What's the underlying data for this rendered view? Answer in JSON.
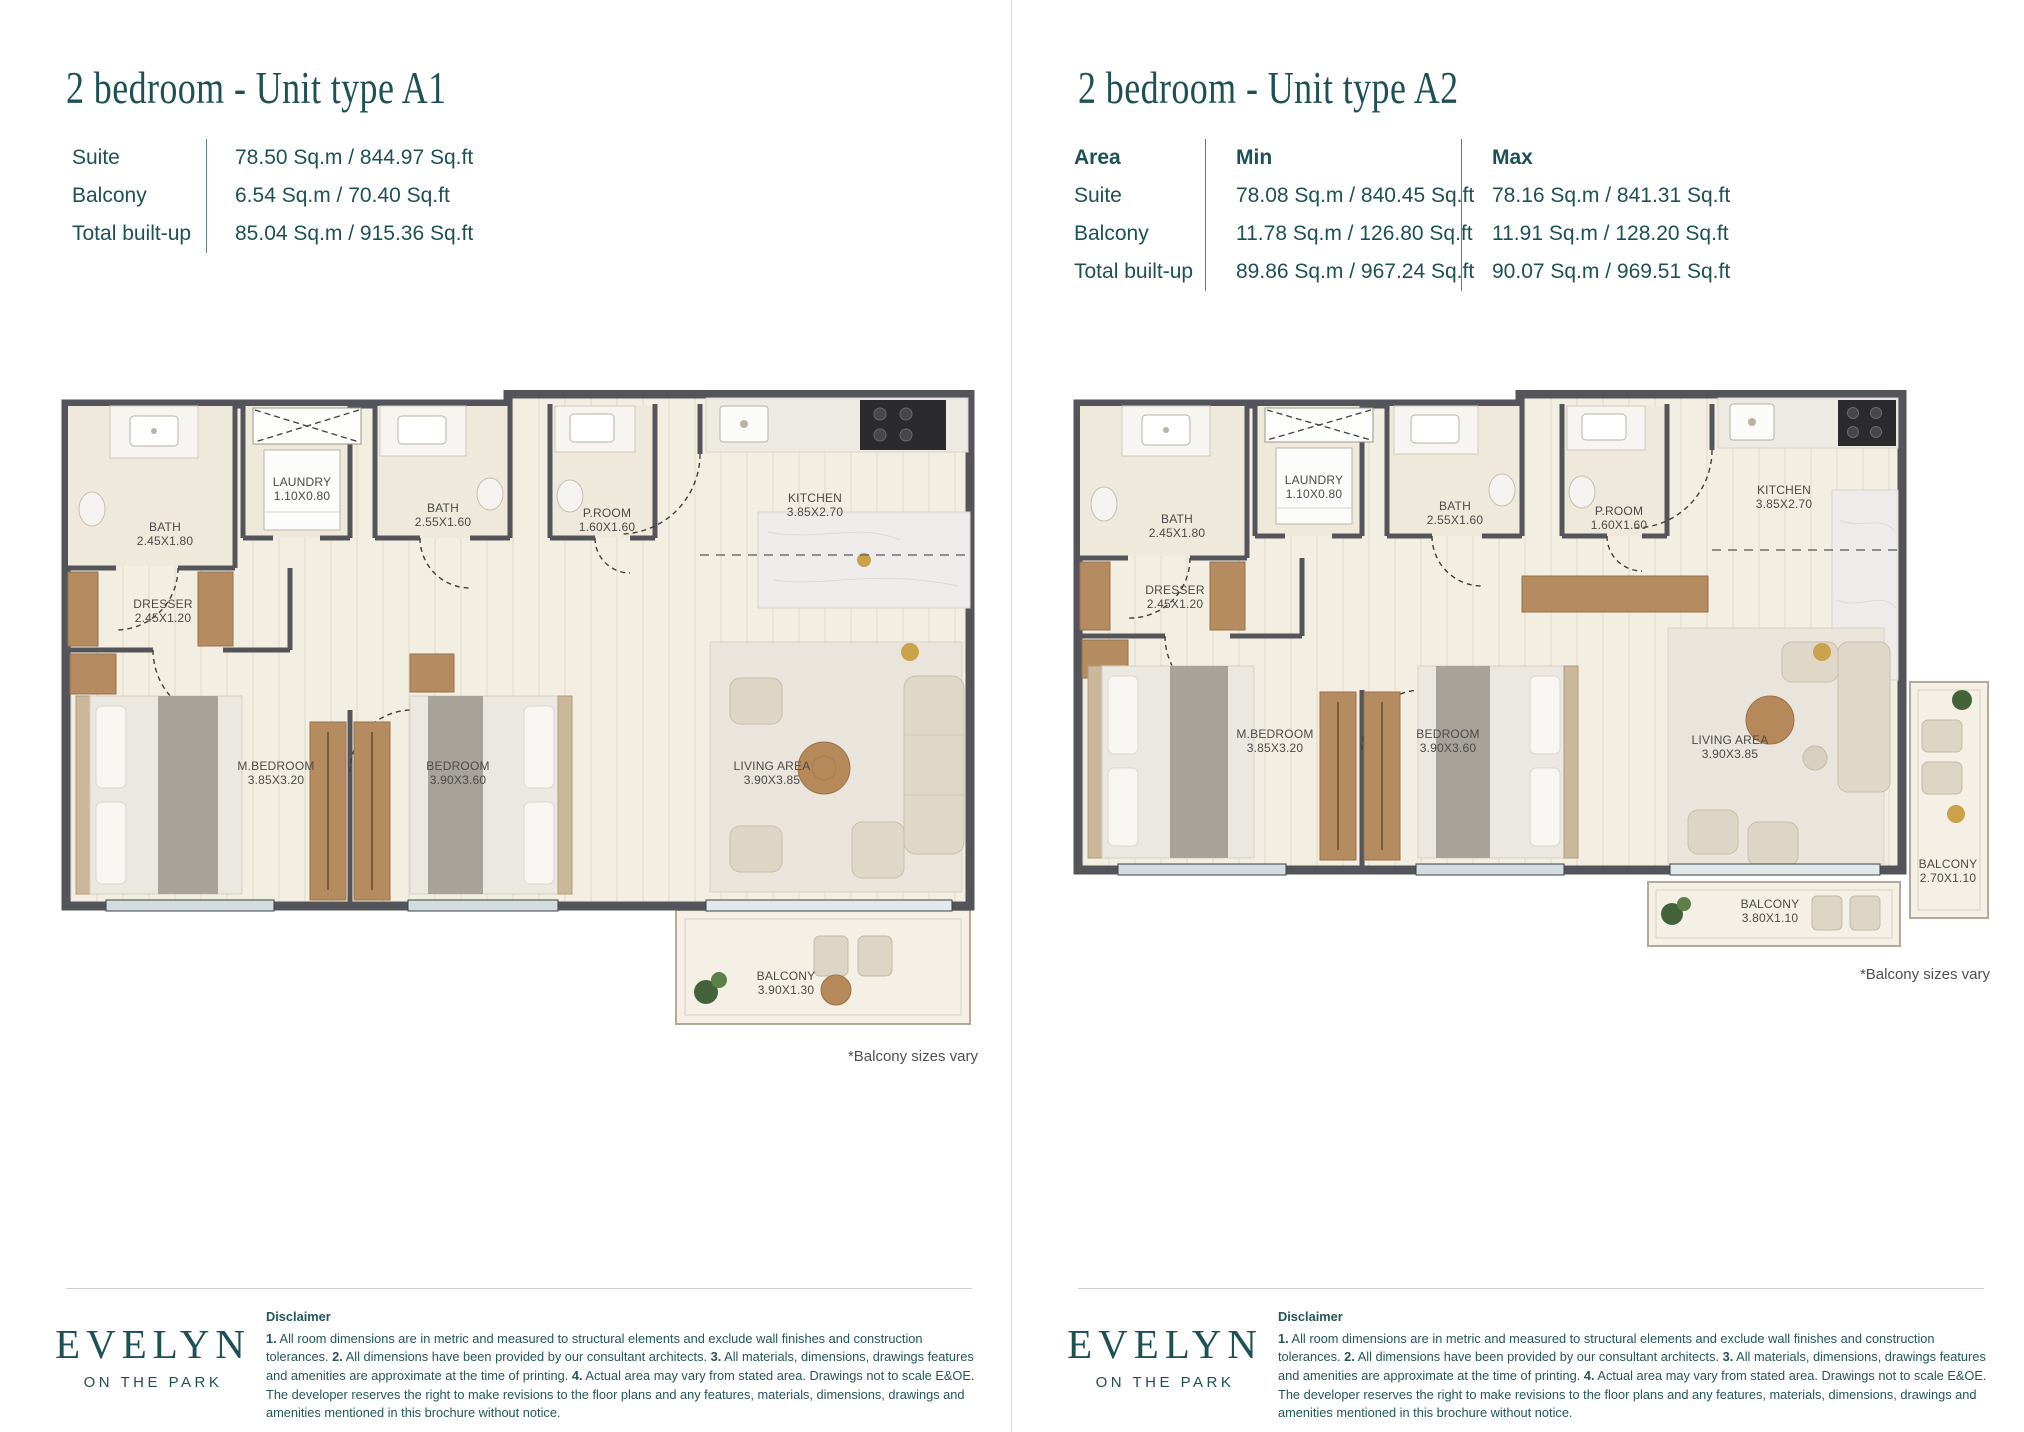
{
  "colors": {
    "accent_teal": "#1d5156",
    "wall_gray": "#54555a",
    "floor_cream": "#f3eee2",
    "wood": "#b58c60",
    "room_label_gray": "#4a4a4a",
    "note_gray": "#4f4f4f",
    "divider_gray": "#dedede"
  },
  "pages": [
    {
      "title": "2 bedroom - Unit type A1",
      "spec_table": {
        "rows": [
          {
            "label": "Suite",
            "value": "78.50 Sq.m / 844.97 Sq.ft"
          },
          {
            "label": "Balcony",
            "value": "6.54 Sq.m / 70.40 Sq.ft"
          },
          {
            "label": "Total built-up",
            "value": "85.04 Sq.m / 915.36 Sq.ft"
          }
        ]
      },
      "floorplan": {
        "rooms": {
          "bath_main": {
            "name": "BATH",
            "dim": "2.45X1.80"
          },
          "laundry": {
            "name": "LAUNDRY",
            "dim": "1.10X0.80"
          },
          "bath2": {
            "name": "BATH",
            "dim": "2.55X1.60"
          },
          "powder_room": {
            "name": "P.ROOM",
            "dim": "1.60X1.60"
          },
          "kitchen": {
            "name": "KITCHEN",
            "dim": "3.85X2.70"
          },
          "dresser": {
            "name": "DRESSER",
            "dim": "2.45X1.20"
          },
          "master_bedroom": {
            "name": "M.BEDROOM",
            "dim": "3.85X3.20"
          },
          "bedroom": {
            "name": "BEDROOM",
            "dim": "3.90X3.60"
          },
          "living_area": {
            "name": "LIVING AREA",
            "dim": "3.90X3.85"
          },
          "balcony": {
            "name": "BALCONY",
            "dim": "3.90X1.30"
          }
        }
      },
      "balcony_note": "*Balcony sizes vary"
    },
    {
      "title": "2 bedroom - Unit type A2",
      "area_table": {
        "headers": {
          "area": "Area",
          "min": "Min",
          "max": "Max"
        },
        "rows": [
          {
            "label": "Suite",
            "min": "78.08 Sq.m / 840.45 Sq.ft",
            "max": "78.16 Sq.m / 841.31 Sq.ft"
          },
          {
            "label": "Balcony",
            "min": "11.78 Sq.m / 126.80 Sq.ft",
            "max": "11.91 Sq.m / 128.20 Sq.ft"
          },
          {
            "label": "Total built-up",
            "min": "89.86 Sq.m / 967.24 Sq.ft",
            "max": "90.07 Sq.m / 969.51 Sq.ft"
          }
        ]
      },
      "floorplan": {
        "rooms": {
          "bath_main": {
            "name": "BATH",
            "dim": "2.45X1.80"
          },
          "laundry": {
            "name": "LAUNDRY",
            "dim": "1.10X0.80"
          },
          "bath2": {
            "name": "BATH",
            "dim": "2.55X1.60"
          },
          "powder_room": {
            "name": "P.ROOM",
            "dim": "1.60X1.60"
          },
          "kitchen": {
            "name": "KITCHEN",
            "dim": "3.85X2.70"
          },
          "dresser": {
            "name": "DRESSER",
            "dim": "2.45X1.20"
          },
          "master_bedroom": {
            "name": "M.BEDROOM",
            "dim": "3.85X3.20"
          },
          "bedroom": {
            "name": "BEDROOM",
            "dim": "3.90X3.60"
          },
          "living_area": {
            "name": "LIVING AREA",
            "dim": "3.90X3.85"
          },
          "balcony": {
            "name": "BALCONY",
            "dim": "3.80X1.10"
          },
          "balcony_side": {
            "name": "BALCONY",
            "dim": "2.70X1.10"
          }
        }
      },
      "balcony_note": "*Balcony sizes vary"
    }
  ],
  "footer": {
    "logo_line1": "EVELYN",
    "logo_line2": "ON THE PARK",
    "disclaimer_title": "Disclaimer",
    "disclaimer_segments": [
      {
        "text": "1.",
        "bold": true
      },
      {
        "text": " All room dimensions are in metric and measured to structural elements and exclude wall finishes and construction tolerances. ",
        "bold": false
      },
      {
        "text": "2.",
        "bold": true
      },
      {
        "text": " All dimensions have been provided by our consultant architects. ",
        "bold": false
      },
      {
        "text": "3.",
        "bold": true
      },
      {
        "text": " All materials, dimensions, drawings features and amenities are approximate at the time of printing. ",
        "bold": false
      },
      {
        "text": "4.",
        "bold": true
      },
      {
        "text": " Actual area may vary from stated area. Drawings not to scale E&OE. The developer reserves the right to make revisions to the floor plans and any features, materials, dimensions, drawings and amenities mentioned in this brochure without notice.",
        "bold": false
      }
    ]
  }
}
